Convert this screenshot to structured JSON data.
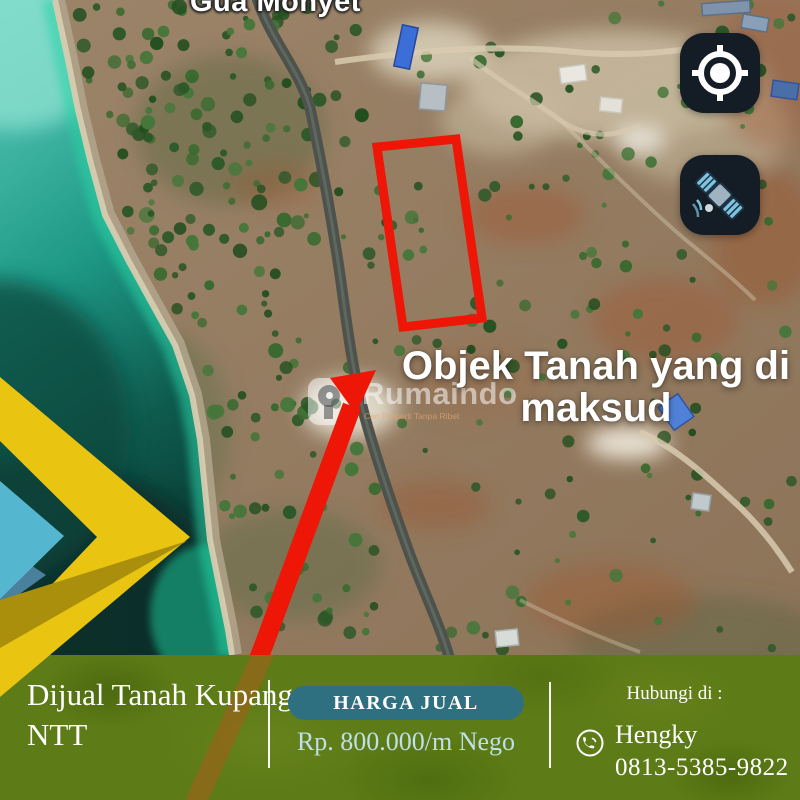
{
  "map": {
    "place_label": "Gua Monyet",
    "annotation": {
      "line1": "Objek Tanah yang di",
      "line2": "maksud"
    },
    "watermark": {
      "brand": "Rumaindo",
      "tagline": "Cari Properti Tanpa Ribet"
    },
    "marker": {
      "shape": "rectangle-outline",
      "color": "#ee1606"
    },
    "controls": {
      "locate": "crosshair-target",
      "layers": "satellite"
    }
  },
  "banner": {
    "title_line1": "Dijual Tanah Kupang",
    "title_line2": "NTT",
    "price": {
      "label": "HARGA JUAL",
      "value": "Rp. 800.000/m Nego",
      "badge_color": "#2f7080"
    },
    "contact": {
      "heading": "Hubungi di :",
      "name": "Hengky",
      "phone": "0813-5385-9822"
    }
  },
  "colors": {
    "banner_green": "#5d7b16",
    "accent_yellow": "#e9c512",
    "accent_cyan": "#55b7cf",
    "accent_slate": "#49809b",
    "marker_red": "#ee1606",
    "button_bg": "#141d26",
    "price_text": "#bfdfe9"
  }
}
